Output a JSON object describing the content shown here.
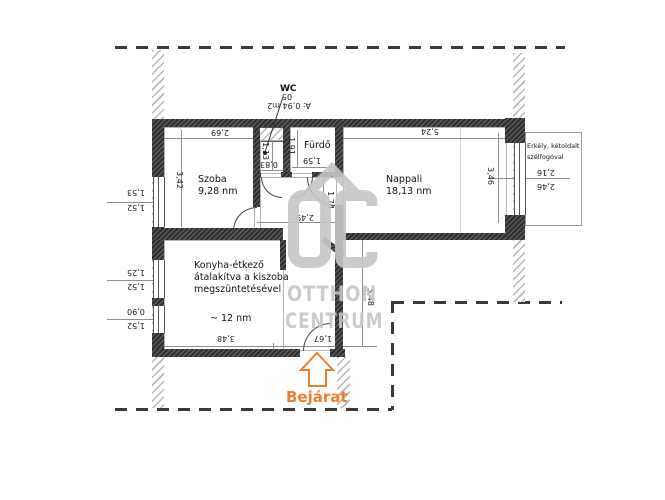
{
  "labels": {
    "wc": "WC",
    "szoba_name": "Szoba",
    "szoba_area": "9,28 nm",
    "nappali_name": "Nappali",
    "nappali_area": "18,13 nm",
    "furdo_name": "Fürdő",
    "konyha_line1": "Konyha-étkező",
    "konyha_line2": "átalakítva a kiszoba",
    "konyha_line3": "megszüntetésével",
    "konyha_area": "~ 12 nm",
    "erkely_line1": "Erkély, kétoldalt",
    "erkely_line2": "szélfogóval",
    "bejarat": "Bejárat"
  },
  "watermark": {
    "brand_line1": "OTTHON",
    "brand_line2": "CENTRUM"
  },
  "dimensions": [
    {
      "text": "2,69",
      "x": 220,
      "y": 132,
      "rot": 180
    },
    {
      "text": "5,24",
      "x": 430,
      "y": 131,
      "rot": 180
    },
    {
      "text": "3,42",
      "x": 179,
      "y": 180,
      "rot": 90
    },
    {
      "text": "1,53",
      "x": 136,
      "y": 192,
      "rot": 180
    },
    {
      "text": "1,52",
      "x": 136,
      "y": 207,
      "rot": 180
    },
    {
      "text": "1,25",
      "x": 136,
      "y": 272,
      "rot": 180
    },
    {
      "text": "1,52",
      "x": 136,
      "y": 286,
      "rot": 180
    },
    {
      "text": "0,90",
      "x": 136,
      "y": 311,
      "rot": 180
    },
    {
      "text": "1,52",
      "x": 136,
      "y": 325,
      "rot": 180
    },
    {
      "text": "1,13",
      "x": 265,
      "y": 151,
      "rot": 90
    },
    {
      "text": "0,83",
      "x": 269,
      "y": 164,
      "rot": 180
    },
    {
      "text": "1,91",
      "x": 291,
      "y": 146,
      "rot": 90
    },
    {
      "text": "1,59",
      "x": 312,
      "y": 160,
      "rot": 180
    },
    {
      "text": "2,49",
      "x": 305,
      "y": 217,
      "rot": 180
    },
    {
      "text": "1,74",
      "x": 330,
      "y": 200,
      "rot": 90
    },
    {
      "text": "3,46",
      "x": 490,
      "y": 176,
      "rot": 90
    },
    {
      "text": "2,16",
      "x": 546,
      "y": 172,
      "rot": 180
    },
    {
      "text": "2,46",
      "x": 546,
      "y": 186,
      "rot": 180
    },
    {
      "text": "3,48",
      "x": 226,
      "y": 338,
      "rot": 180
    },
    {
      "text": "1,67",
      "x": 323,
      "y": 338,
      "rot": 180
    },
    {
      "text": "3,48",
      "x": 370,
      "y": 297,
      "rot": 90
    },
    {
      "text": "05",
      "x": 287,
      "y": 96,
      "rot": 180
    },
    {
      "text": "A: 0,94 m2",
      "x": 289,
      "y": 105,
      "rot": 180
    }
  ],
  "colors": {
    "entrance_orange": "#ef7d2a",
    "watermark_gray": "#c6c6c6"
  }
}
